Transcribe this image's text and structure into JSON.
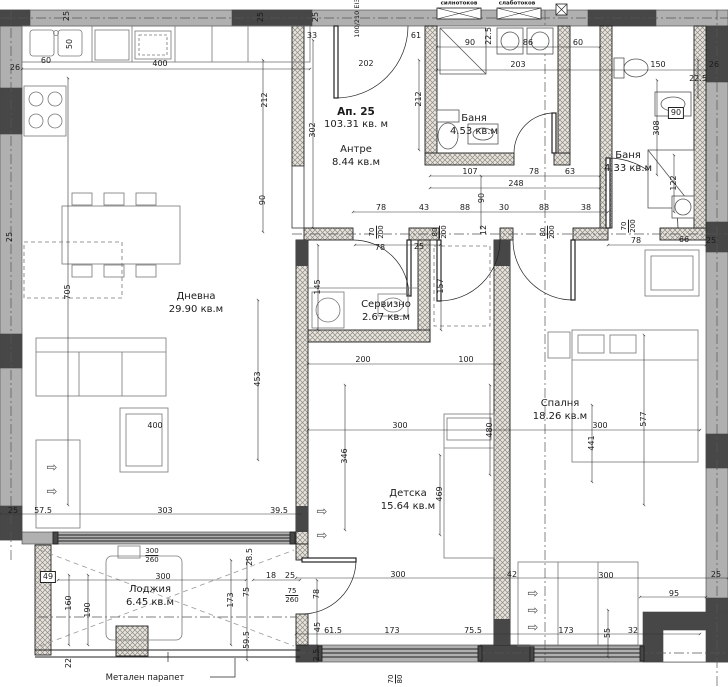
{
  "apartment": {
    "label": "Ап. 25",
    "area": "103.31 кв. м"
  },
  "rooms": [
    {
      "name": "Дневна",
      "area": "29.90 кв.м",
      "x": 196,
      "y": 297
    },
    {
      "name": "Антре",
      "area": "8.44 кв.м",
      "x": 356,
      "y": 150
    },
    {
      "name": "Баня",
      "area": "4.53 кв.м",
      "x": 474,
      "y": 119
    },
    {
      "name": "Баня",
      "area": "4.33 кв.м",
      "x": 628,
      "y": 156
    },
    {
      "name": "Сервизно",
      "area": "2.67 кв.м",
      "x": 386,
      "y": 305
    },
    {
      "name": "Спалня",
      "area": "18.26 кв.м",
      "x": 560,
      "y": 404
    },
    {
      "name": "Детска",
      "area": "15.64 кв.м",
      "x": 408,
      "y": 494
    },
    {
      "name": "Лоджия",
      "area": "6.45 кв.м",
      "x": 150,
      "y": 590
    }
  ],
  "annotations": {
    "railing": "Метален парапет",
    "panel1": "силнотоков",
    "panel2": "слаботоков",
    "entry_door": "100/210 EI30"
  },
  "dims": [
    {
      "t": "25",
      "x": 67,
      "y": 16,
      "rot": 1
    },
    {
      "t": "60",
      "x": 46,
      "y": 61
    },
    {
      "t": "26",
      "x": 15,
      "y": 68
    },
    {
      "t": "50",
      "x": 70,
      "y": 44,
      "rot": 1
    },
    {
      "t": "400",
      "x": 160,
      "y": 64
    },
    {
      "t": "25",
      "x": 261,
      "y": 17,
      "rot": 1
    },
    {
      "t": "25",
      "x": 316,
      "y": 17,
      "rot": 1
    },
    {
      "t": "33",
      "x": 312,
      "y": 36
    },
    {
      "t": "202",
      "x": 366,
      "y": 64
    },
    {
      "t": "61",
      "x": 416,
      "y": 36
    },
    {
      "t": "212",
      "x": 265,
      "y": 100,
      "rot": 1
    },
    {
      "t": "212",
      "x": 419,
      "y": 99,
      "rot": 1
    },
    {
      "t": "302",
      "x": 313,
      "y": 130,
      "rot": 1
    },
    {
      "t": "90",
      "x": 263,
      "y": 200,
      "rot": 1
    },
    {
      "t": "705",
      "x": 68,
      "y": 292,
      "rot": 1
    },
    {
      "t": "90",
      "x": 470,
      "y": 43
    },
    {
      "t": "86",
      "x": 528,
      "y": 43
    },
    {
      "t": "60",
      "x": 578,
      "y": 43
    },
    {
      "t": "203",
      "x": 518,
      "y": 65
    },
    {
      "t": "22.5",
      "x": 489,
      "y": 36,
      "rot": 1
    },
    {
      "t": "150",
      "x": 658,
      "y": 65
    },
    {
      "t": "26",
      "x": 714,
      "y": 65
    },
    {
      "t": "22.5",
      "x": 698,
      "y": 79
    },
    {
      "t": "90",
      "x": 676,
      "y": 113,
      "box": 1
    },
    {
      "t": "308",
      "x": 657,
      "y": 128,
      "rot": 1
    },
    {
      "t": "122",
      "x": 674,
      "y": 183,
      "rot": 1
    },
    {
      "t": "107",
      "x": 470,
      "y": 172
    },
    {
      "t": "78",
      "x": 534,
      "y": 172
    },
    {
      "t": "63",
      "x": 570,
      "y": 172
    },
    {
      "t": "248",
      "x": 516,
      "y": 184
    },
    {
      "t": "90",
      "x": 482,
      "y": 198,
      "rot": 1
    },
    {
      "t": "78",
      "x": 381,
      "y": 208
    },
    {
      "t": "43",
      "x": 424,
      "y": 208
    },
    {
      "t": "88",
      "x": 465,
      "y": 208
    },
    {
      "t": "30",
      "x": 504,
      "y": 208
    },
    {
      "t": "88",
      "x": 544,
      "y": 208
    },
    {
      "t": "38",
      "x": 586,
      "y": 208
    },
    {
      "t": "12",
      "x": 484,
      "y": 230,
      "rot": 1
    },
    {
      "t": "78",
      "x": 380,
      "y": 248
    },
    {
      "t": "25",
      "x": 419,
      "y": 247
    },
    {
      "t": "78",
      "x": 636,
      "y": 241
    },
    {
      "t": "66",
      "x": 684,
      "y": 240
    },
    {
      "t": "25",
      "x": 711,
      "y": 241
    },
    {
      "t": "145",
      "x": 318,
      "y": 287,
      "rot": 1
    },
    {
      "t": "157",
      "x": 441,
      "y": 286,
      "rot": 1
    },
    {
      "t": "200",
      "x": 363,
      "y": 360
    },
    {
      "t": "100",
      "x": 466,
      "y": 360
    },
    {
      "t": "453",
      "x": 258,
      "y": 379,
      "rot": 1
    },
    {
      "t": "400",
      "x": 155,
      "y": 426
    },
    {
      "t": "346",
      "x": 345,
      "y": 456,
      "rot": 1
    },
    {
      "t": "300",
      "x": 400,
      "y": 426
    },
    {
      "t": "480",
      "x": 490,
      "y": 430,
      "rot": 1
    },
    {
      "t": "300",
      "x": 600,
      "y": 426
    },
    {
      "t": "577",
      "x": 644,
      "y": 419,
      "rot": 1
    },
    {
      "t": "441",
      "x": 592,
      "y": 443,
      "rot": 1
    },
    {
      "t": "469",
      "x": 440,
      "y": 494,
      "rot": 1
    },
    {
      "t": "25",
      "x": 13,
      "y": 511
    },
    {
      "t": "57.5",
      "x": 43,
      "y": 511
    },
    {
      "t": "303",
      "x": 165,
      "y": 511
    },
    {
      "t": "39.5",
      "x": 279,
      "y": 511
    },
    {
      "t": "25",
      "x": 10,
      "y": 237,
      "rot": 1
    },
    {
      "t": "28.5",
      "x": 250,
      "y": 557,
      "rot": 1
    },
    {
      "t": "300",
      "x": 163,
      "y": 577
    },
    {
      "t": "49",
      "x": 48,
      "y": 577,
      "box": 1
    },
    {
      "t": "160",
      "x": 69,
      "y": 603,
      "rot": 1
    },
    {
      "t": "190",
      "x": 88,
      "y": 610,
      "rot": 1
    },
    {
      "t": "173",
      "x": 231,
      "y": 600,
      "rot": 1
    },
    {
      "t": "75",
      "x": 247,
      "y": 592,
      "rot": 1
    },
    {
      "t": "59.5",
      "x": 247,
      "y": 640,
      "rot": 1
    },
    {
      "t": "22",
      "x": 69,
      "y": 663,
      "rot": 1
    },
    {
      "t": "18",
      "x": 271,
      "y": 576
    },
    {
      "t": "25",
      "x": 290,
      "y": 576
    },
    {
      "t": "78",
      "x": 317,
      "y": 594,
      "rot": 1
    },
    {
      "t": "45",
      "x": 318,
      "y": 627,
      "rot": 1
    },
    {
      "t": "2.5",
      "x": 317,
      "y": 655,
      "rot": 1
    },
    {
      "t": "61.5",
      "x": 333,
      "y": 631
    },
    {
      "t": "173",
      "x": 392,
      "y": 631
    },
    {
      "t": "75.5",
      "x": 473,
      "y": 631
    },
    {
      "t": "300",
      "x": 398,
      "y": 575
    },
    {
      "t": "42",
      "x": 512,
      "y": 575
    },
    {
      "t": "300",
      "x": 606,
      "y": 576
    },
    {
      "t": "95",
      "x": 674,
      "y": 594
    },
    {
      "t": "25",
      "x": 716,
      "y": 575
    },
    {
      "t": "173",
      "x": 566,
      "y": 631
    },
    {
      "t": "55",
      "x": 608,
      "y": 633,
      "rot": 1
    },
    {
      "t": "32",
      "x": 633,
      "y": 631
    }
  ],
  "specs": [
    {
      "num": "70",
      "den": "200",
      "x": 377,
      "y": 232,
      "rot": 1
    },
    {
      "num": "80",
      "den": "200",
      "x": 440,
      "y": 232,
      "rot": 1
    },
    {
      "num": "80",
      "den": "200",
      "x": 548,
      "y": 232,
      "rot": 1
    },
    {
      "num": "70",
      "den": "200",
      "x": 629,
      "y": 226,
      "rot": 1
    },
    {
      "num": "300",
      "den": "260",
      "x": 152,
      "y": 556
    },
    {
      "num": "75",
      "den": "260",
      "x": 292,
      "y": 596
    },
    {
      "num": "70",
      "den": "80",
      "x": 396,
      "y": 679,
      "rot": 1
    }
  ],
  "vents": [
    {
      "x": 52,
      "y": 468
    },
    {
      "x": 52,
      "y": 492
    },
    {
      "x": 322,
      "y": 512
    },
    {
      "x": 322,
      "y": 536
    },
    {
      "x": 533,
      "y": 594
    },
    {
      "x": 533,
      "y": 611
    },
    {
      "x": 533,
      "y": 628
    }
  ],
  "colors": {
    "wall_fill": "#b0b0b0",
    "column_fill": "#474747",
    "hatch_line": "#8f8a82",
    "line": "#1b1b1b",
    "dim_line": "#333333"
  }
}
